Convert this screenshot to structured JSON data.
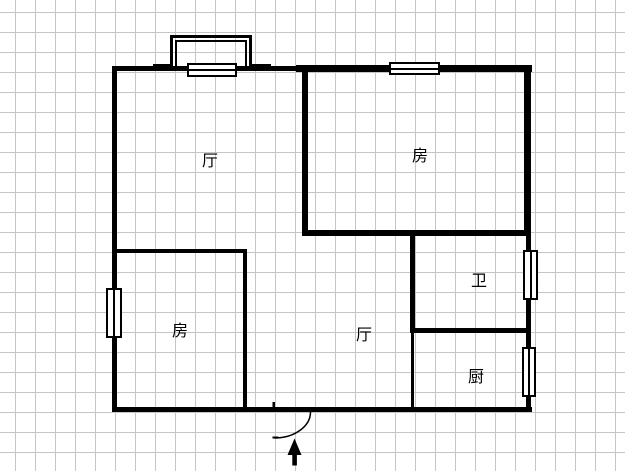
{
  "floorplan": {
    "rooms": [
      {
        "id": "hall-upper",
        "label": "厅"
      },
      {
        "id": "bedroom-top-right",
        "label": "房"
      },
      {
        "id": "bathroom",
        "label": "卫"
      },
      {
        "id": "bedroom-bottom-left",
        "label": "房"
      },
      {
        "id": "hall-lower",
        "label": "厅"
      },
      {
        "id": "kitchen",
        "label": "厨"
      }
    ],
    "colors": {
      "wall": "#000000",
      "grid_line": "#c5c5c5",
      "background": "#ffffff",
      "window_fill": "#ffffff"
    },
    "symbols": {
      "entrance_arrow": "entrance-arrow-icon",
      "door_swing": "door-swing-arc",
      "window": "window-symbol",
      "bay_window": "bay-window"
    }
  }
}
